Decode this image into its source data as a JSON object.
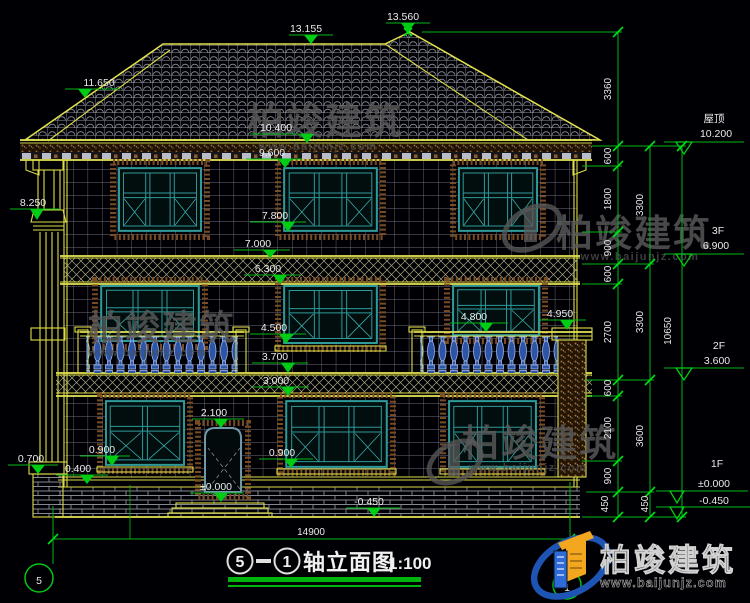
{
  "markers": [
    "13.560",
    "13.155",
    "11.650",
    "10.400",
    "9.600",
    "7.800",
    "7.000",
    "6.300",
    "4.500",
    "3.700",
    "3.000",
    "4.800",
    "4.950",
    "8.250",
    "2.100",
    "0.900",
    "0.900",
    "±0.000",
    "-0.450",
    "0.700",
    "0.400"
  ],
  "dims": {
    "total_width": "14900",
    "inner": [
      "3360",
      "600",
      "1800",
      "900",
      "600",
      "2700",
      "600",
      "2100",
      "900",
      "450"
    ],
    "mid": [
      "3300",
      "3300",
      "3600",
      "450"
    ],
    "overall": "10650",
    "levels": [
      {
        "name": "屋顶",
        "value": "10.200"
      },
      {
        "name": "3F",
        "value": "6.900"
      },
      {
        "name": "2F",
        "value": "3.600"
      },
      {
        "name": "1F",
        "value": "±0.000"
      },
      {
        "name": "",
        "value": "-0.450"
      }
    ]
  },
  "title": {
    "axis_start": "5",
    "axis_end": "1",
    "name": "轴立面图",
    "scale": "1:100"
  },
  "axis_bubbles": {
    "left": "5",
    "right": "1"
  },
  "watermark": {
    "brand": "柏竣建筑",
    "url": "www.baijunjz.com"
  },
  "logo": {
    "brand": "柏竣建筑",
    "url": "www.baijunjz.com"
  }
}
